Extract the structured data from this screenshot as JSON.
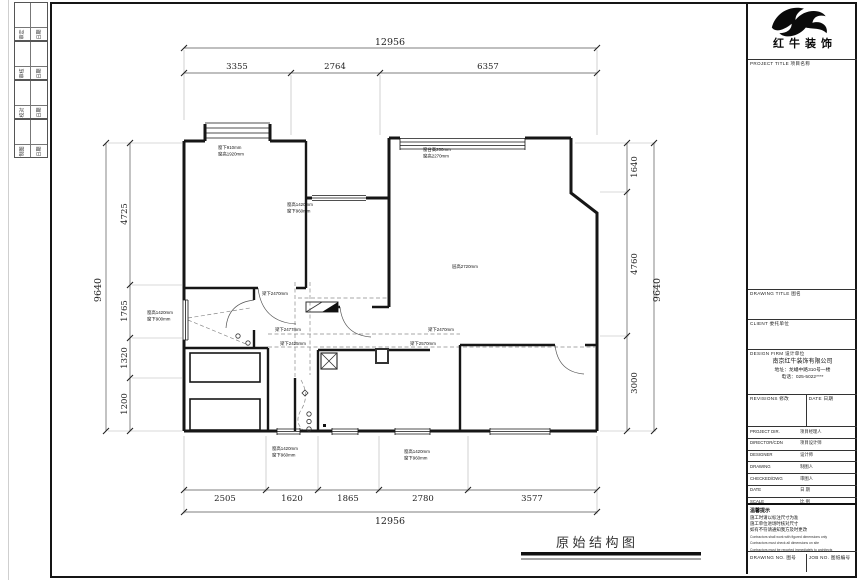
{
  "sheet": {
    "binding_groups": [
      {
        "a": "审定",
        "b": "日期"
      },
      {
        "a": "审核",
        "b": "日期"
      },
      {
        "a": "校对",
        "b": "日期"
      },
      {
        "a": "制图",
        "b": "日期"
      }
    ]
  },
  "dims": {
    "top_total": "12956",
    "top_segments": [
      "3355",
      "2764",
      "6357"
    ],
    "bottom_segments": [
      "2505",
      "1620",
      "1865",
      "2780",
      "3577"
    ],
    "bottom_total": "12956",
    "left_total": "9640",
    "left_segments": [
      "4725",
      "1765",
      "1320",
      "1200"
    ],
    "right_segments": [
      "1640",
      "4760",
      "3000"
    ],
    "right_total": "9640"
  },
  "plan": {
    "labels": {
      "bed1_l1": "窗下910mm",
      "bed1_l2": "窗高1920mm",
      "kitchen_l1": "窗高1420mm",
      "kitchen_l2": "窗下960mm",
      "living_top_l1": "窗台高200mm",
      "living_top_l2": "窗高2270mm",
      "ceiling": "层高2720mm",
      "bath_l1": "窗高1420mm",
      "bath_l2": "窗下900mm",
      "beam_a": "梁下2470mm",
      "beam_b": "梁下2477mm",
      "beam_c": "梁下2470mm",
      "beam_d": "梁下2425mm",
      "beam_e": "梁下2570mm",
      "bwin1_l1": "窗高1420mm",
      "bwin1_l2": "窗下960mm",
      "bwin2_l1": "窗高1420mm",
      "bwin2_l2": "窗下960mm"
    },
    "drawing_title": "原始结构图"
  },
  "titleblock": {
    "logo_text": "红牛装饰",
    "project_title_label": "PROJECT TITLE  项目名称",
    "drawing_title_label": "DRAWING TITLE  图名",
    "client_label": "CLIENT  委托单位",
    "design_firm_label": "DESIGN FIRM  设计单位",
    "company_name": "南京红牛装饰有限公司",
    "company_address": "地址：龙蟠中路310号一楼",
    "company_phone": "电话：025-5022****",
    "revisions_label": "REVISIONS  修改",
    "date_col_label": "DATE  日期",
    "rows": [
      {
        "label": "PROJECT DIR.",
        "zh": "项目经理人"
      },
      {
        "label": "DIRECTOR/CDN",
        "zh": "项目设计师"
      },
      {
        "label": "DESIGNER",
        "zh": "设计师"
      },
      {
        "label": "DRAWING",
        "zh": "制图人"
      },
      {
        "label": "CHECKED/DWG",
        "zh": "审图人"
      },
      {
        "label": "DATE",
        "zh": "日 期"
      },
      {
        "label": "SCALE",
        "zh": "比 例"
      }
    ],
    "notes_title": "温馨提示",
    "notes_zh": [
      "施工时请以标注尺寸为准",
      "施工单位进场时核对尺寸",
      "如有不符请通知我方及时更改"
    ],
    "notes_en": [
      "Contractors shall work with figured dimensions only",
      "Contractors must check all dimensions on site",
      "Contractors must be reported immediately to architects"
    ],
    "drawing_no_label": "DRAWING NO.  图号",
    "job_no_label": "JOB NO.  图纸编号"
  }
}
